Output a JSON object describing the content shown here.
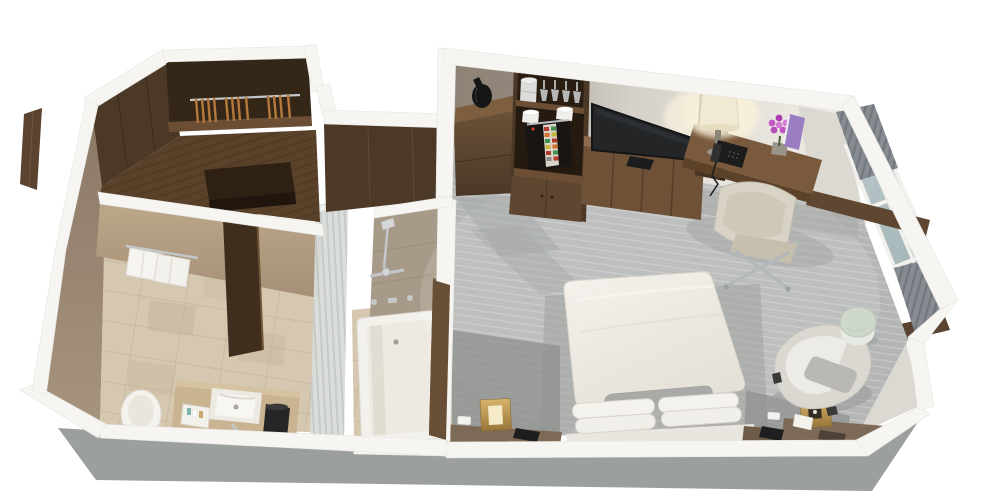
{
  "meta": {
    "title": "3D isometric cutaway rendering of a hotel guest room floor plan",
    "width_px": 1000,
    "height_px": 503,
    "view": "top-down isometric cutaway, white background, no visible text"
  },
  "palette": {
    "background": "#ffffff",
    "wall_cap": "#f6f5f2",
    "wall_exterior": "#9ba09f",
    "wall_face_light": "#dcd9d3",
    "wall_face_shaded": "#8e8376",
    "carpet": "#b3b6b4",
    "carpet_shadow": "#8d908e",
    "tile_floor": "#d5c7b0",
    "bath_wall": "#b39d83",
    "wood_darkest": "#352718",
    "wood_dark": "#4c3827",
    "wood_medium": "#6e5136",
    "wood_desk": "#7a5a3c",
    "wood_floor": "#5a412a",
    "counter_stone": "#c9b391",
    "fixture_white": "#f3f1ec",
    "shower_glass": "#d8dbd8",
    "window_glass": "#aabec1",
    "curtain": "#878c92",
    "bed_linen": "#f0ede7",
    "pillow": "#f4f2ed",
    "bolster": "#a9a9a7",
    "desk_chair_cream": "#d9d3c5",
    "armchair_cream": "#dbd8d2",
    "brass": "#c9a55f",
    "tv_screen": "#232527",
    "coffee_machine": "#191512",
    "flower_accent": "#c257c4",
    "book_accent": "#9b7dc1",
    "lamp_shade": "#f0e9d3",
    "side_table_green": "#cfd9cb"
  },
  "scene": {
    "rooms": [
      {
        "id": "bathroom",
        "items": [
          "toilet",
          "vanity-counter",
          "undermount-sink",
          "amenity-tray",
          "folded-towel",
          "waste-bin",
          "wall-towels",
          "open-door",
          "tile-floor"
        ]
      },
      {
        "id": "tub-room",
        "items": [
          "bathtub",
          "shower-fixtures",
          "glass-partition"
        ]
      },
      {
        "id": "entry-closet",
        "items": [
          "entry-door",
          "wardrobe-shelf",
          "clothes-hangers",
          "luggage-bench",
          "wood-floor"
        ]
      },
      {
        "id": "bedroom",
        "items": [
          "welcome-shelf-with-vase",
          "minibar-cabinet",
          "ice-bucket",
          "stemware",
          "coffee-cups",
          "coffee-machine",
          "tv-console",
          "flat-screen-tv",
          "desk",
          "desk-lamp",
          "telephone",
          "flower-vase",
          "book",
          "desk-chair",
          "king-bed",
          "bolster-pillow",
          "pillows",
          "nightstand-left",
          "brass-cube-lamp-left",
          "alarm-phone-left",
          "nightstand-right",
          "brass-cube-lamp-right",
          "tissue-box",
          "alarm-phone-right",
          "armchair",
          "round-side-table",
          "windows",
          "curtains",
          "carpet"
        ]
      }
    ]
  }
}
